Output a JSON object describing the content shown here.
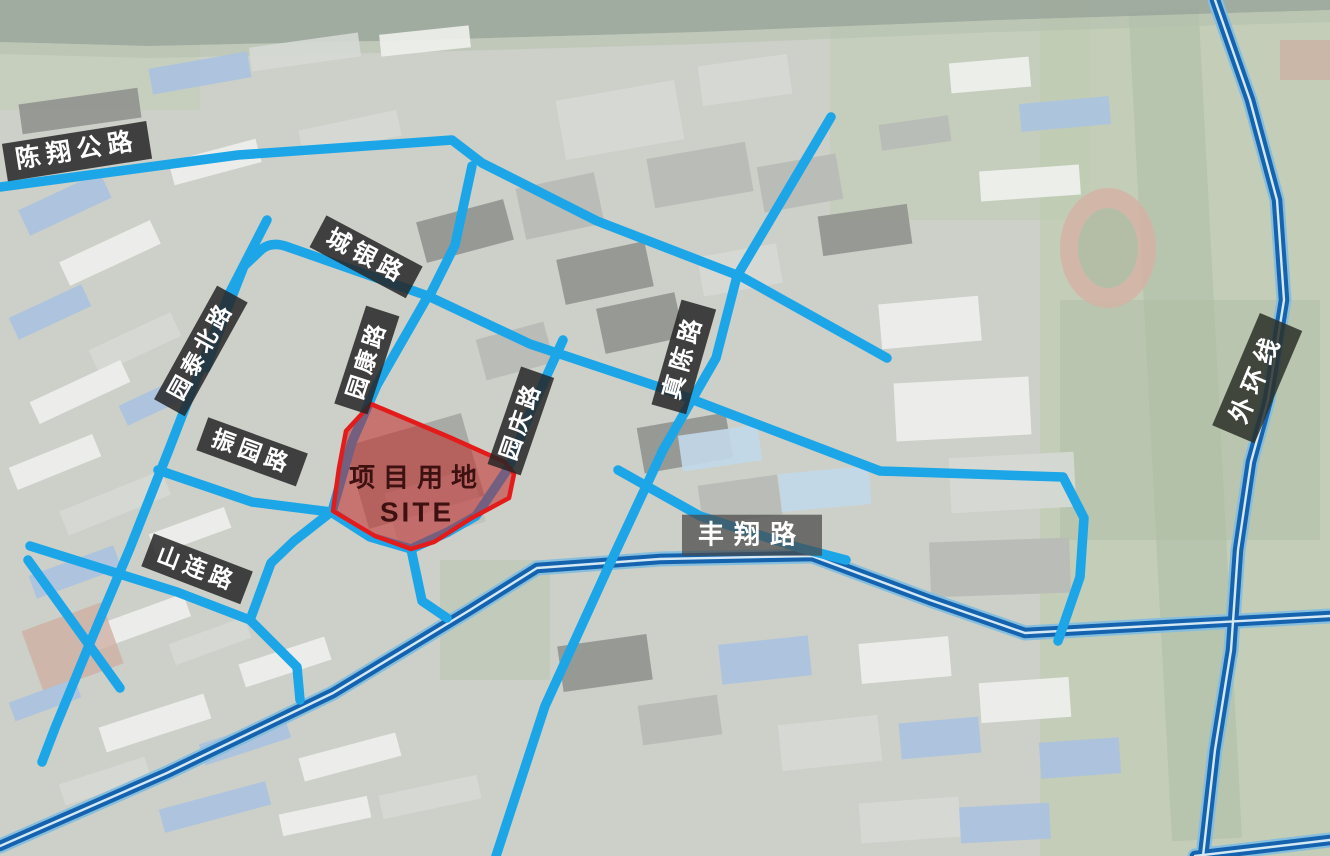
{
  "map": {
    "site": {
      "label_line1": "项目用地",
      "label_line2": "SITE"
    },
    "road_labels": {
      "chenxiang": "陈翔公路",
      "chengyin": "城银路",
      "yuantaibei": "园泰北路",
      "yuankang": "园康路",
      "yuanqing": "园庆路",
      "zhenchen": "真陈路",
      "zhenyuan": "振园路",
      "shanlian": "山连路",
      "fengxiang": "丰翔路",
      "waihuan": "外环线"
    },
    "colors": {
      "road": "#1ca6e8",
      "expressway": "#1563ae",
      "expressway_casing": "#86bede",
      "site_fill": "#c41f1f",
      "site_border": "#e31b1b",
      "label_bg": "#262626",
      "label_text": "#ffffff"
    }
  }
}
